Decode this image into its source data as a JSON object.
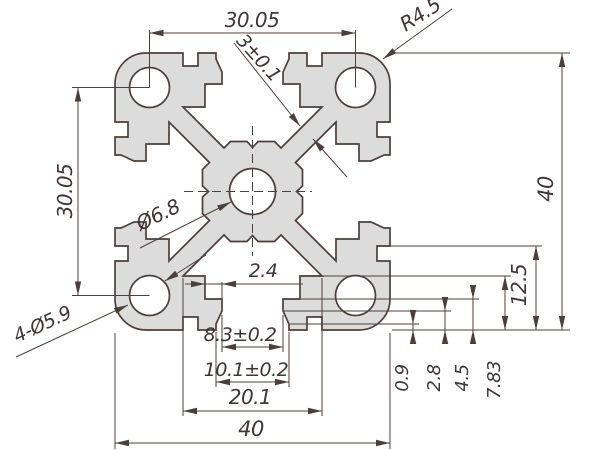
{
  "drawing": {
    "type": "technical-drawing",
    "subject": "aluminum extrusion profile cross-section",
    "colors": {
      "outline": "#4b3f3d",
      "profile_fill": "#dcdcdc",
      "background": "#ffffff",
      "text": "#3f3737"
    },
    "dims": {
      "top_hole_spacing": "30.05",
      "left_hole_spacing": "30.05",
      "corner_radius": "R4.5",
      "web_thickness": "3±0.1",
      "overall_height": "40",
      "overall_width": "40",
      "center_hole": "Ø6.8",
      "corner_holes": "4-Ø5.9",
      "lip_width": "2.4",
      "slot_opening": "8.3±0.2",
      "slot_opening_outer": "10.1±0.2",
      "cavity_width": "20.1",
      "depth_a": "0.9",
      "depth_b": "2.8",
      "depth_c": "4.5",
      "depth_d": "7.83",
      "depth_e": "12.5"
    }
  }
}
